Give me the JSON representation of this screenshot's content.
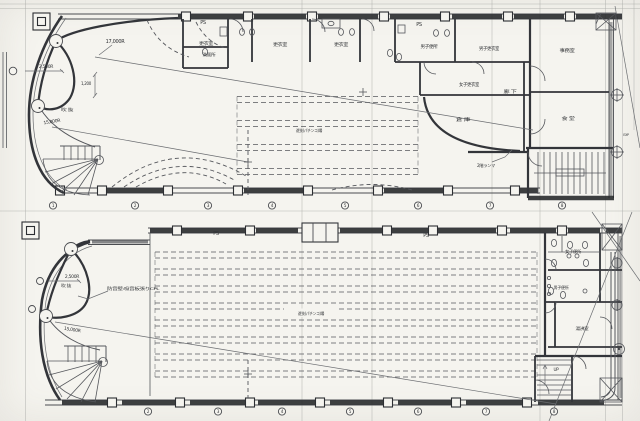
{
  "colors": {
    "paper": "#f5f4ef",
    "line": "#55575c",
    "wall": "#33353a",
    "hatch": "#232528",
    "text": "#2f3134"
  },
  "upper_plan": {
    "ps_left": "PS",
    "ps_right": "PS",
    "rooms": {
      "locker_a": "更衣室",
      "washroom": "洗面所",
      "locker_b": "更衣室",
      "locker_c": "更衣室",
      "mens_toilet": "男子便所",
      "mens_locker": "男子更衣室",
      "womens_locker": "女子更衣室",
      "corridor": "廊 下",
      "storage": "倉 庫",
      "office": "事務室",
      "dining": "食 堂",
      "hall": "遊技(パチンコ)場",
      "void": "吹 抜"
    },
    "dimensions": {
      "r_17000": "17,000R",
      "r_2500": "2,500R",
      "w_1200": "1,200",
      "r_15000": "15,000R"
    },
    "notes": {
      "ranma": "2階ランマ",
      "exp": "EXP"
    }
  },
  "lower_plan": {
    "ps_left": "PS",
    "ps_right": "PS",
    "rooms": {
      "hall": "遊技(パチンコ)場",
      "womens_toilet": "女子便所",
      "mens_toilet": "男子便所",
      "kitchenette": "湯沸室",
      "void": "吹 抜"
    },
    "dimensions": {
      "r_2500": "2,500R",
      "r_15000": "15,000R"
    },
    "notes": {
      "soundproof": "防音壁:吸音板張りCPL",
      "up": "UP"
    }
  },
  "grid_bubbles": {
    "upper": [
      "1",
      "2",
      "3",
      "4",
      "5",
      "6",
      "7",
      "8"
    ],
    "lower": [
      "2",
      "3",
      "4",
      "5",
      "6",
      "7",
      "8"
    ]
  }
}
